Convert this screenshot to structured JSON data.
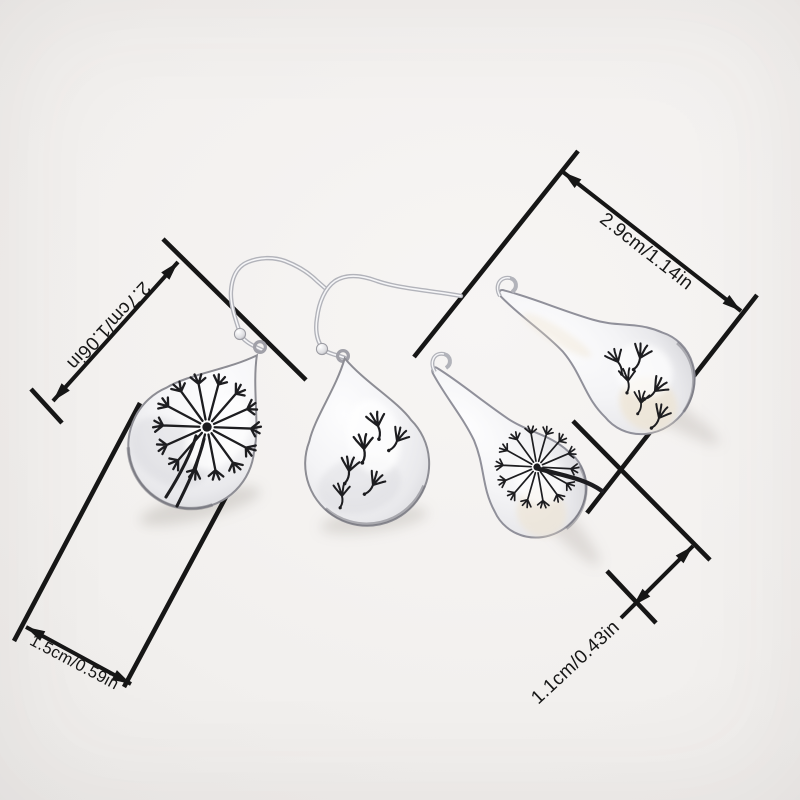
{
  "annotations": {
    "dim_top_right": {
      "label": "2.9cm/1.14in"
    },
    "dim_left": {
      "label": "2.7cm/1.06in"
    },
    "dim_bottom_left": {
      "label": "1.5cm/0.59in"
    },
    "dim_bottom_right": {
      "label": "1.1cm/0.43in"
    }
  },
  "objects": {
    "left_pair": [
      "teardrop-earring-dandelion-puff",
      "teardrop-earring-floating-seeds"
    ],
    "right_pair": [
      "spoon-earring-floating-seeds",
      "spoon-earring-dandelion-puff"
    ]
  },
  "colors": {
    "background": "#f0eeec",
    "annotation_line": "#161616",
    "annotation_text": "#171717",
    "metal_light": "#f7f7f9",
    "metal_mid": "#c7c8cd",
    "metal_dark": "#8a8a91",
    "engraving": "#1d1d20",
    "reflection_cream": "#eee3cf"
  }
}
